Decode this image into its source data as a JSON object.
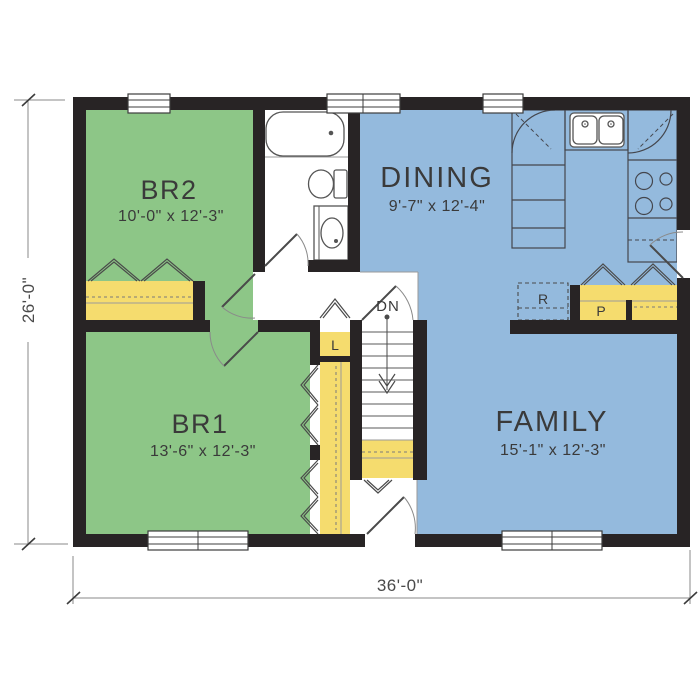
{
  "plan": {
    "rooms": {
      "br2": {
        "label": "BR2",
        "dims": "10'-0\" x 12'-3\""
      },
      "dining": {
        "label": "DINING",
        "dims": "9'-7\" x 12'-4\""
      },
      "br1": {
        "label": "BR1",
        "dims": "13'-6\" x 12'-3\""
      },
      "family": {
        "label": "FAMILY",
        "dims": "15'-1\" x 12'-3\""
      }
    },
    "labels": {
      "stairs_direction": "DN",
      "linen_closet": "L",
      "refrigerator": "R",
      "pantry": "P"
    },
    "overall_dimensions": {
      "width": "36'-0\"",
      "depth": "26'-0\""
    },
    "colors": {
      "bedroom_fill": "#8dc687",
      "living_fill": "#94badd",
      "closet_fill": "#f5dc6e",
      "wall": "#282425",
      "background": "#ffffff"
    }
  }
}
